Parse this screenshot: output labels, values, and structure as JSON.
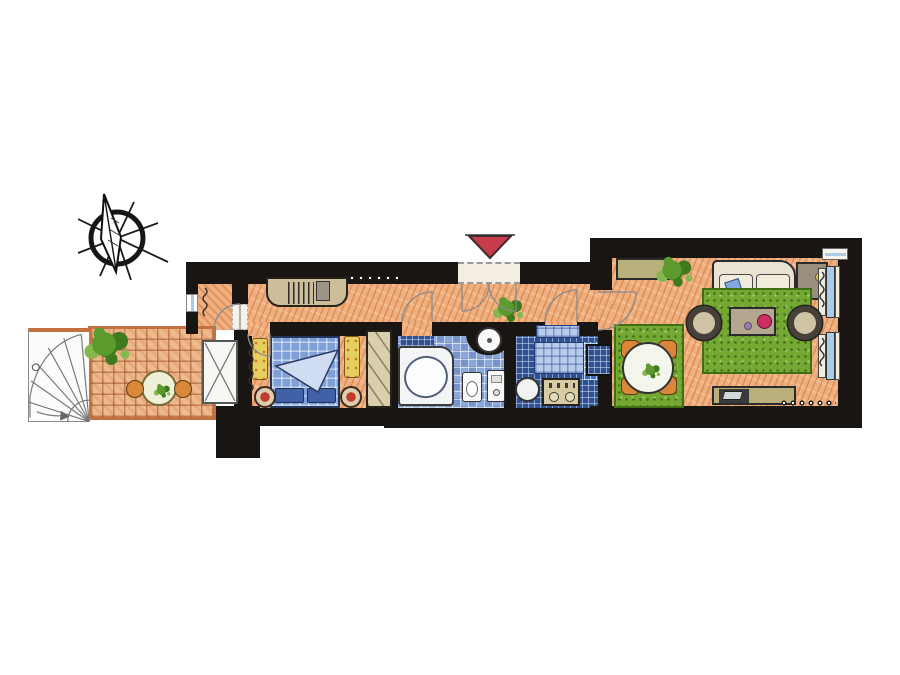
{
  "meta": {
    "type": "apartment floor plan",
    "style": "hand-drawn colored pencil drawing",
    "text_labels": []
  },
  "colors": {
    "paper": "#ffffff",
    "wall": "#181512",
    "floor_orange": "#f0af7e",
    "terrace_tile": "#edba8e",
    "terrace_edge": "#c4703f",
    "bath_tile": "#8ca8da",
    "kitchen_tile": "#31508f",
    "tile_light": "#b8cbe9",
    "rug_green": "#74a833",
    "rug_green_dark": "#3e6f15",
    "bed_blue": "#7fa0d6",
    "pillow_blue": "#4061a8",
    "fold_blue": "#cfdcf2",
    "sofa_beige": "#eae3d2",
    "cushion_cream": "#f2ecdc",
    "pillow_sky": "#86a8dc",
    "wood_tan": "#cdbd98",
    "olive": "#b9b07c",
    "chair_orange": "#d9873a",
    "stool_red": "#c23a2e",
    "accent_red": "#c63c4c",
    "lamp_yellow": "#d8c830",
    "window_blue": "#a9cce8",
    "sill_cream": "#f1ece0",
    "plant_dark": "#3f7a1c",
    "plant_mid": "#5d9a2e",
    "plant_light": "#86b84e",
    "rug_yellow": "#e6cf5e",
    "table_red": "#cc2d62",
    "armchair_ring": "#474038",
    "armchair_seat": "#cfc3a6",
    "basin_white": "#fafafa"
  },
  "plan": {
    "north_marker": "compass-rose pointing up-left",
    "entrance_marker": "red triangle pointing down at entrance door",
    "rooms": [
      {
        "name": "spiral-staircase",
        "elements": [
          "fan of steps",
          "down arrow",
          "newel post"
        ]
      },
      {
        "name": "terrace",
        "floor": "terracotta tile grid",
        "elements": [
          "round table",
          "two orange chairs",
          "potted plant"
        ]
      },
      {
        "name": "balcony",
        "floor": "orange hatch",
        "elements": [
          "radiator",
          "window",
          "door to hallway"
        ]
      },
      {
        "name": "bedroom",
        "floor": "orange hatch",
        "elements": [
          "double bed with blue quilt",
          "two pillows",
          "folded duvet",
          "two yellow bedside rugs",
          "two round stools",
          "mirrored wardrobe",
          "radiator",
          "french door to terrace"
        ]
      },
      {
        "name": "hallway",
        "floor": "orange hatch",
        "elements": [
          "entrance double door",
          "built-in closet with hangers",
          "coat hooks",
          "potted plant",
          "washbasin niche"
        ]
      },
      {
        "name": "bathroom",
        "floor": "blue checker tiles",
        "elements": [
          "corner bathtub",
          "toilet",
          "boiler",
          "round washbasin",
          "shower tiles"
        ]
      },
      {
        "name": "kitchen",
        "floor": "navy grid tiles",
        "elements": [
          "counter",
          "checker table",
          "stove with burners",
          "round table",
          "pass-through window"
        ]
      },
      {
        "name": "living-room",
        "floor": "orange hatch",
        "elements": [
          "sofa with blue pillow",
          "coffee table with red bowl",
          "two round armchairs",
          "green rug",
          "sideboard",
          "corner cabinet with lamp",
          "tv console",
          "two windows with radiators",
          "radiator dots",
          "potted plant"
        ]
      },
      {
        "name": "dining-area",
        "floor": "orange hatch",
        "elements": [
          "green rug",
          "round dining table",
          "four orange chairs"
        ]
      }
    ]
  }
}
